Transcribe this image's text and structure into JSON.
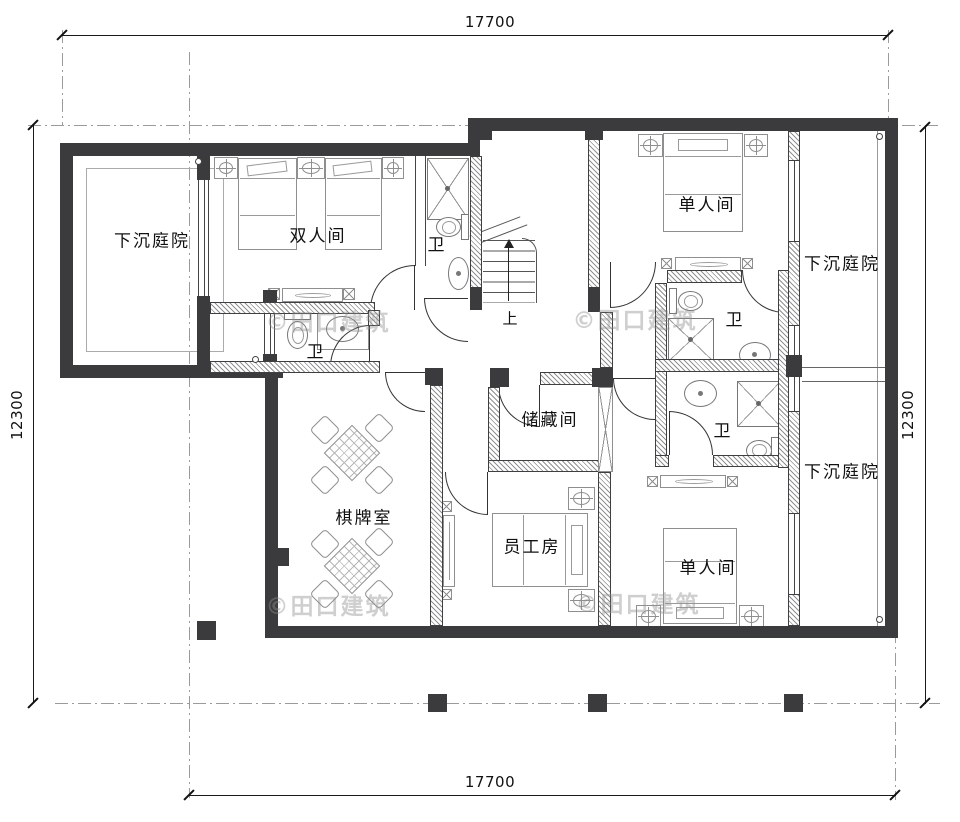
{
  "dimensions": {
    "top": "17700",
    "bottom": "17700",
    "left": "12300",
    "right": "12300"
  },
  "rooms": {
    "courtyard_left": "下沉庭院",
    "double_room": "双人间",
    "bath_left": "卫",
    "bath_center": "卫",
    "bath_right_top": "卫",
    "bath_right_bottom": "卫",
    "single_room_top": "单人间",
    "single_room_bottom": "单人间",
    "courtyard_right_top": "下沉庭院",
    "courtyard_right_bottom": "下沉庭院",
    "chess_room": "棋牌室",
    "storage_room": "储藏间",
    "staff_room": "员工房",
    "stairs_up": "上"
  },
  "watermark": "©田口建筑"
}
